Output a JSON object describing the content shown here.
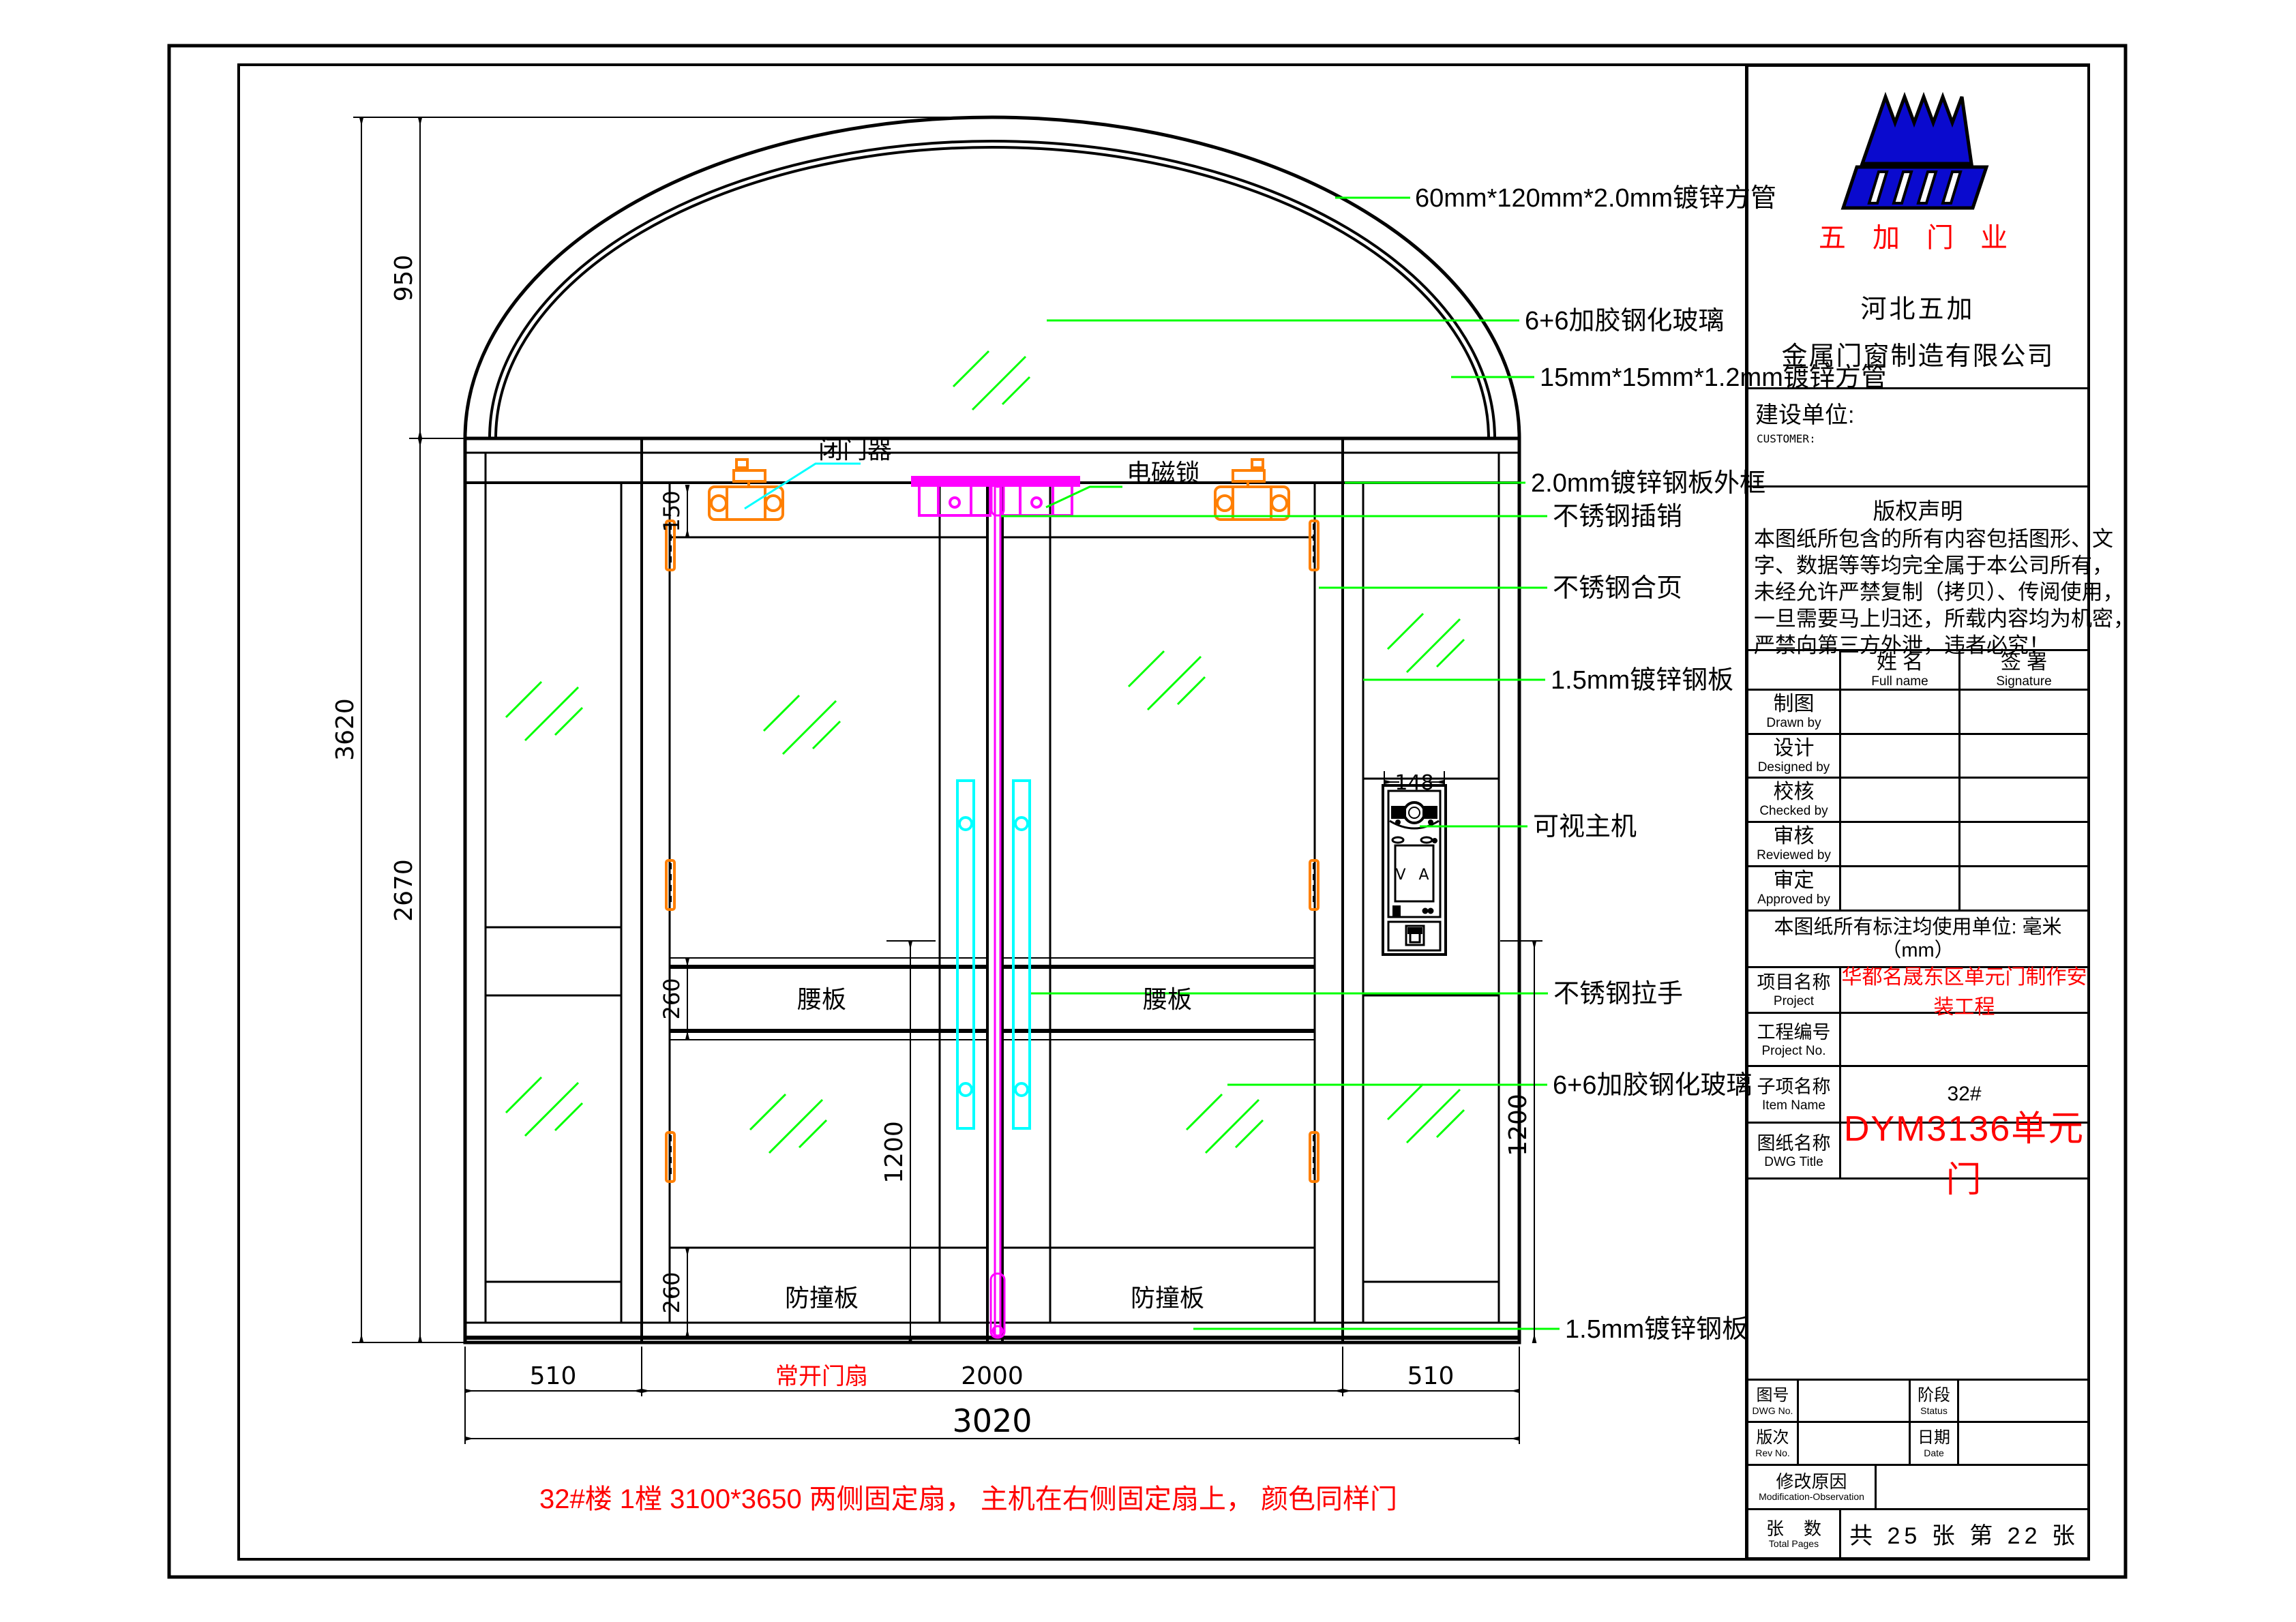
{
  "drawing": {
    "colors": {
      "leader": "#00ff00",
      "glass": "#00ff00",
      "handle": "#00ffff",
      "hardware_orange": "#ff7f00",
      "lock_magenta": "#ff00ff",
      "red": "#ff0000",
      "logo_blue": "#0a0ace"
    },
    "callouts": [
      {
        "label": "60mm*120mm*2.0mm镀锌方管"
      },
      {
        "label": "6+6加胶钢化玻璃"
      },
      {
        "label": "15mm*15mm*1.2mm镀锌方管"
      },
      {
        "label": "2.0mm镀锌钢板外框"
      },
      {
        "label": "不锈钢插销"
      },
      {
        "label": "不锈钢合页"
      },
      {
        "label": "1.5mm镀锌钢板"
      },
      {
        "label": "可视主机"
      },
      {
        "label": "不锈钢拉手"
      },
      {
        "label": "6+6加胶钢化玻璃"
      },
      {
        "label": "1.5mm镀锌钢板"
      }
    ],
    "part_labels": {
      "door_closer": "闭门器",
      "maglock": "电磁锁",
      "waist_panel": "腰板",
      "bump_panel": "防撞板",
      "intercom_screen": "V A"
    },
    "dims": {
      "arch_h": "950",
      "total_h": "3620",
      "body_h": "2670",
      "top_rail": "150",
      "waist": "260",
      "lower_glass": "1200",
      "intercom_w": "148",
      "side_w": "510",
      "door_w": "2000",
      "total_w": "3020"
    },
    "red_labels": {
      "door_leaf": "常开门扇",
      "note": "32#楼  1樘 3100*3650  两侧固定扇， 主机在右侧固定扇上，  颜色同样门"
    }
  },
  "titleblock": {
    "logo_caption": "五 加 门 业",
    "company_line1": "河北五加",
    "company_line2": "金属门窗制造有限公司",
    "customer_label": "建设单位:",
    "customer_sub": "CUSTOMER:",
    "copyright_title": "版权声明",
    "copyright_lines": [
      "本图纸所包含的所有内容包括图形、文",
      "字、数据等等均完全属于本公司所有，",
      "未经允许严禁复制（拷贝）、传阅使用，",
      "一旦需要马上归还，所载内容均为机密，",
      "严禁向第三方外泄，违者必究！"
    ],
    "sign_header": {
      "name_cn": "姓  名",
      "name_en": "Full name",
      "sig_cn": "签  署",
      "sig_en": "Signature"
    },
    "sign_rows": [
      {
        "cn": "制图",
        "en": "Drawn by"
      },
      {
        "cn": "设计",
        "en": "Designed by"
      },
      {
        "cn": "校核",
        "en": "Checked by"
      },
      {
        "cn": "审核",
        "en": "Reviewed by"
      },
      {
        "cn": "审定",
        "en": "Approved by"
      }
    ],
    "units_note": "本图纸所有标注均使用单位: 毫米（mm）",
    "project": {
      "cn": "项目名称",
      "en": "Project",
      "value": "华都名晟东区单元门制作安装工程"
    },
    "project_no": {
      "cn": "工程编号",
      "en": "Project No."
    },
    "item": {
      "cn": "子项名称",
      "en": "Item Name",
      "value": "32#"
    },
    "dwg_title": {
      "cn": "图纸名称",
      "en": "DWG Title",
      "value": "DYM3136单元门"
    },
    "dwg_no": {
      "cn": "图号",
      "en": "DWG No."
    },
    "status": {
      "cn": "阶段",
      "en": "Status"
    },
    "rev": {
      "cn": "版次",
      "en": "Rev No."
    },
    "date": {
      "cn": "日期",
      "en": "Date"
    },
    "modification": {
      "cn": "修改原因",
      "en": "Modification-Observation"
    },
    "pages": {
      "cn": "张    数",
      "en": "Total Pages",
      "value": "共 25 张 第 22 张"
    }
  }
}
